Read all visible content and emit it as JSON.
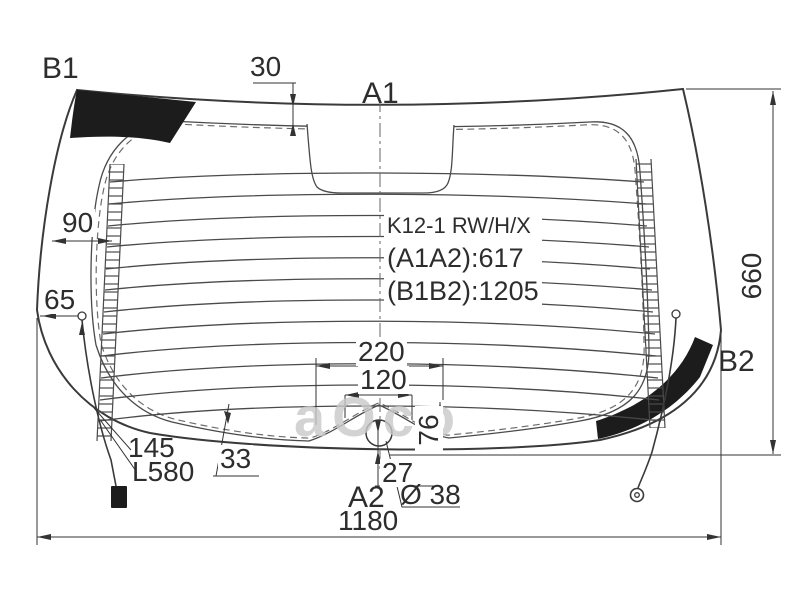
{
  "drawing": {
    "corner_labels": {
      "b1": "B1",
      "a1": "A1",
      "b2": "B2",
      "a2": "A2"
    },
    "part_info": {
      "model_code": "K12-1 RW/H/X",
      "a_distance": "(A1A2):617",
      "b_distance": "(B1B2):1205"
    },
    "dimensions": {
      "top_band": "30",
      "edge_to_busbar": "90",
      "edge_to_terminal": "65",
      "glass_height": "660",
      "glass_width": "1180",
      "hump_outer_width": "220",
      "hump_inner_width": "120",
      "hump_height": "76",
      "hole_to_edge": "27",
      "hole_diameter": "Ø 38",
      "bottom_band": "33",
      "wire_offset": "145",
      "wire_length": "L580"
    },
    "watermark": "aOco"
  },
  "colors": {
    "line": "#3a3a3a",
    "dim_line": "#333333",
    "black_fill": "#1c1c1c",
    "watermark": "#c9c9c9",
    "background": "#ffffff"
  }
}
